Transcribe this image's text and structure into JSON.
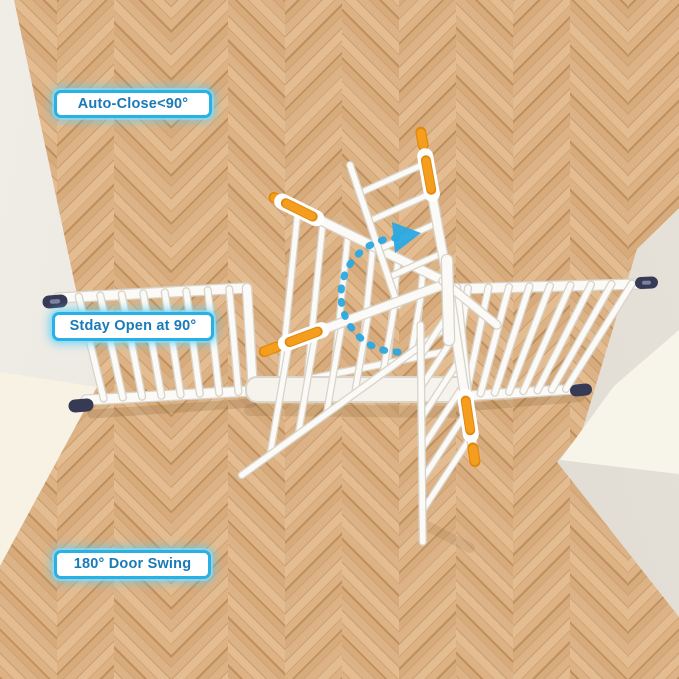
{
  "scene": {
    "description": "White pressure-mounted baby safety gate installed between two walls on a herringbone wood floor, door shown in multiple swing positions"
  },
  "annotations": {
    "auto_close_label": "Auto-Close<90°",
    "stay_open_label": "Stday Open at 90°",
    "door_swing_label": "180° Door Swing"
  },
  "icons": {
    "rotation_arrow": "dashed-arc-rotation-arrow-icon"
  },
  "colors": {
    "label_border": "#29b0e6",
    "label_text": "#1a7ab8",
    "label_glow": "#7fd9f7",
    "arrow_cyan": "#2aa9e1",
    "gate_white": "#fbfaf6",
    "gate_shadow": "#d8d4cb",
    "handle_orange": "#f59d1c",
    "handle_orange_deep": "#e0890f",
    "mount_cap_dark": "#363a54",
    "floor_tan": "#d7ab7c",
    "wall_gray_left": "#eae6df",
    "wall_gray_right": "#dcd7cf",
    "wall_cream": "#f7f2e4"
  }
}
